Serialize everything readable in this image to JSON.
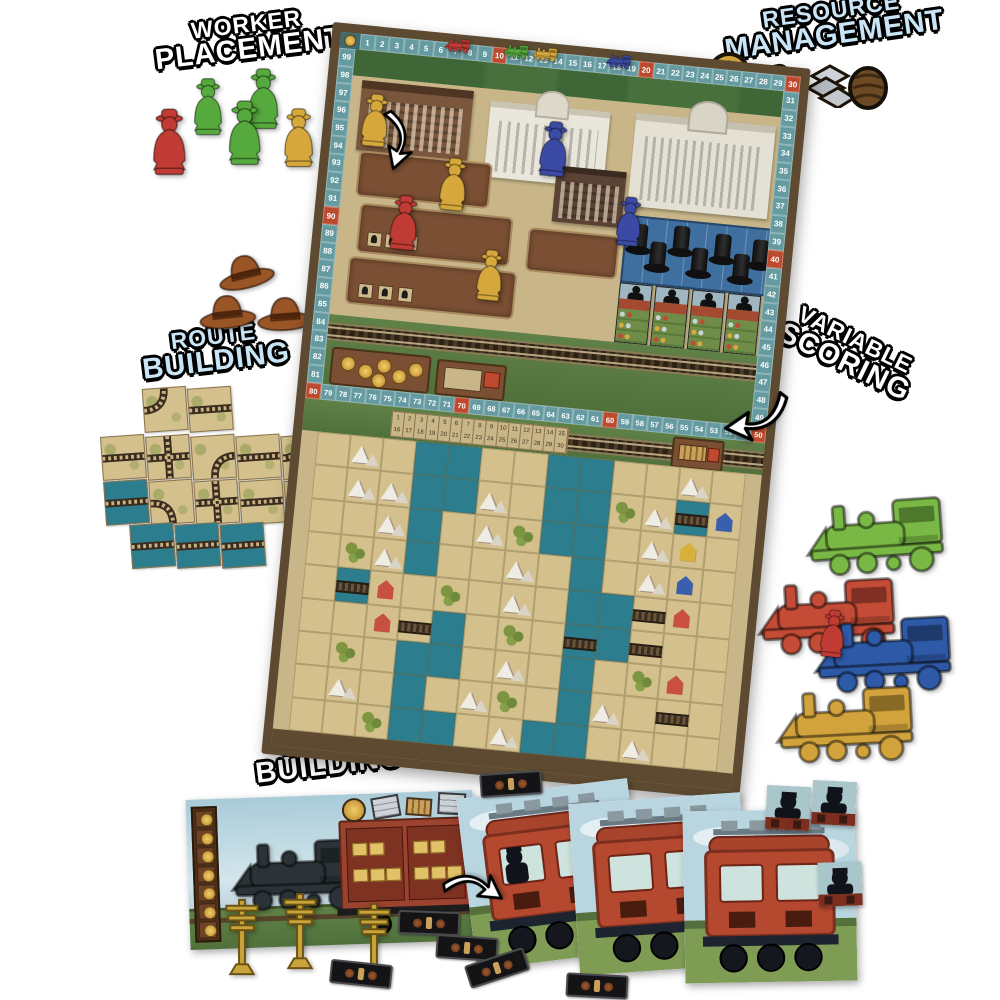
{
  "callouts": {
    "worker_placement": {
      "line1": "WORKER",
      "line2": "PLACEMENT",
      "color": "#ffffff"
    },
    "resource_management": {
      "line1": "RESOURCE",
      "line2": "MANAGEMENT",
      "color": "#c9e4f5"
    },
    "route_building": {
      "line1": "ROUTE",
      "line2": "BUILDING",
      "color": "#c9e4f5"
    },
    "variable_scoring": {
      "line1": "VARIABLE",
      "line2": "SCORING",
      "color": "#ffffff"
    },
    "engine_building": {
      "line1": "ENGINE",
      "line2": "BUILDING",
      "color": "#ffffff"
    }
  },
  "palette": {
    "board_frame": "#5d4a30",
    "board_bg": "#c9b688",
    "track_teal": "#649aa0",
    "track_red": "#bc4a2e",
    "track_corner": "#3e6b70",
    "grass": "#5c7d44",
    "water": "#2c7d8d",
    "desert": "#d4c08d",
    "slot_brown": "#7a4f33",
    "slot_border": "#a98a5f",
    "card_red": "#a34a30",
    "card_green": "#6f8c48"
  },
  "meeple_colors": {
    "red": "#bf3b33",
    "green": "#56a93c",
    "yellow": "#d6a83b",
    "blue": "#3b4aa4"
  },
  "worker_meeples": [
    {
      "color": "green"
    },
    {
      "color": "green"
    },
    {
      "color": "red"
    },
    {
      "color": "green"
    },
    {
      "color": "yellow"
    }
  ],
  "resource_tokens": [
    {
      "name": "gold-coin-token"
    },
    {
      "name": "whiskey-mug-token"
    },
    {
      "name": "steel-ingots-token"
    },
    {
      "name": "goods-barrel-token"
    }
  ],
  "cowboy_hats_count": 3,
  "score_track": {
    "corner": "100",
    "top": [
      1,
      2,
      3,
      4,
      5,
      6,
      7,
      8,
      9,
      10,
      11,
      12,
      13,
      14,
      15,
      16,
      17,
      18,
      19,
      20,
      21,
      22,
      23,
      24,
      25,
      26,
      27,
      28,
      29,
      30
    ],
    "right": [
      31,
      32,
      33,
      34,
      35,
      36,
      37,
      38,
      39,
      40,
      41,
      42,
      43,
      44,
      45,
      46,
      47,
      48,
      49
    ],
    "middle": [
      80,
      79,
      78,
      77,
      76,
      75,
      74,
      73,
      72,
      71,
      70,
      69,
      68,
      67,
      66,
      65,
      64,
      63,
      62,
      61,
      60,
      59,
      58,
      57,
      56,
      55,
      54,
      53,
      52,
      51,
      50
    ],
    "left": [
      99,
      98,
      97,
      96,
      95,
      94,
      93,
      92,
      91,
      90,
      89,
      88,
      87,
      86,
      85,
      84,
      83,
      82,
      81
    ]
  },
  "score_markers": [
    {
      "name": "red-score-marker",
      "color": "#bf3b33",
      "cell": 7
    },
    {
      "name": "green-score-marker",
      "color": "#56a93c",
      "cell": 11
    },
    {
      "name": "yellow-score-marker",
      "color": "#d6a83b",
      "cell": 13
    },
    {
      "name": "blue-score-marker",
      "color": "#3b4aa4",
      "cell": 18
    }
  ],
  "turn_strip": {
    "row1": [
      1,
      2,
      3,
      4,
      5,
      6,
      7,
      8,
      9,
      10,
      11,
      12,
      13,
      14,
      15
    ],
    "row2": [
      16,
      17,
      18,
      19,
      20,
      21,
      22,
      23,
      24,
      25,
      26,
      27,
      28,
      29,
      30
    ]
  },
  "city": {
    "top_hats": 7,
    "contract_cards": 4,
    "car_tiles": 4,
    "coins_on_mat": 6,
    "meeples": [
      {
        "color": "yellow"
      },
      {
        "color": "yellow"
      },
      {
        "color": "red"
      },
      {
        "color": "yellow"
      },
      {
        "color": "blue"
      },
      {
        "color": "blue"
      }
    ]
  },
  "map_legend": {
    "d": "desert",
    "w": "water",
    "m": "mountain",
    "s": "scrub",
    "t": "track",
    "g": "track-bridge",
    "r": "red-station",
    "b": "blue-station",
    "y": "yellow-station"
  },
  "map_grid": [
    "dmdwwddwwddmd",
    "dmmwwmdwwsmgb",
    "ddmwdmswwdmyd",
    "dsmwddmdwdmbd",
    "dgrdsdmdwwtrd",
    "ddrtwdsdgwtdd",
    "dsdwwdmdwdsrd",
    "dmdwdmsdwmdtd",
    "ddswwdmwwdmdd"
  ],
  "route_tiles": [
    "c4",
    "h",
    "h",
    "x",
    "c1",
    "h",
    "c4",
    "bh",
    "c2",
    "x",
    "h",
    "c3",
    "bh",
    "bh",
    "bh"
  ],
  "trains": [
    {
      "name": "green-locomotive",
      "color": "#79b844"
    },
    {
      "name": "red-locomotive",
      "color": "#c44b36"
    },
    {
      "name": "blue-locomotive",
      "color": "#2e59a6"
    },
    {
      "name": "gold-locomotive",
      "color": "#d2a33c"
    }
  ],
  "lone_red_meeple": {
    "color": "red"
  },
  "engine_board": {
    "coin_cells": 7,
    "crates_per_panel": 5,
    "telegraph_poles": 3
  },
  "passenger_cards": [
    {
      "has_passenger": true
    },
    {
      "has_passenger": false
    },
    {
      "has_passenger": false
    }
  ],
  "passenger_tiles_count": 3,
  "goods_strips_count": 6
}
